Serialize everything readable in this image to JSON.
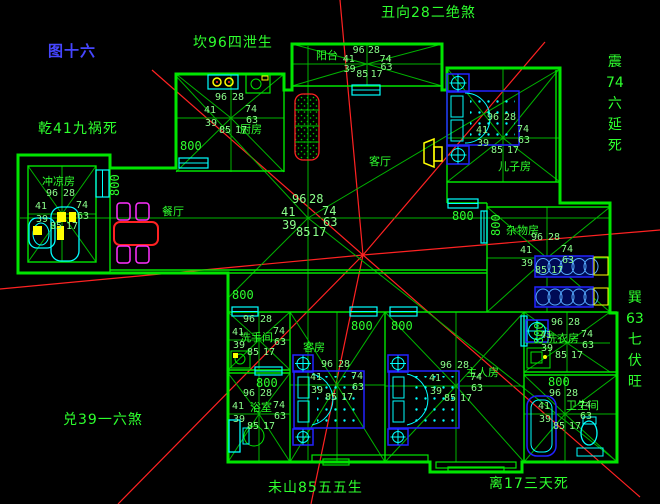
{
  "figure": {
    "label": "图十六",
    "color": "#4646ff"
  },
  "compass": {
    "top_left": {
      "text": "坎96四泄生",
      "x": 193,
      "y": 36
    },
    "top": {
      "text": "丑向28二绝煞",
      "x": 381,
      "y": 6
    },
    "left": {
      "text": "乾41九祸死",
      "x": 38,
      "y": 122
    },
    "bottom_left": {
      "text": "兑39一六煞",
      "x": 63,
      "y": 413
    },
    "bottom": {
      "text": "未山85五五生",
      "x": 268,
      "y": 481
    },
    "bottom_right": {
      "text": "离17三天死",
      "x": 489,
      "y": 477
    },
    "right_top": {
      "stack": [
        "震",
        "74",
        "六",
        "延",
        "死"
      ],
      "x": 606,
      "y": 55
    },
    "right_bottom": {
      "stack": [
        "巽",
        "63",
        "七",
        "伏",
        "旺"
      ],
      "x": 626,
      "y": 291
    }
  },
  "star_values": {
    "top_left": "96",
    "top_right": "28",
    "left": "41",
    "right": "74",
    "lower_left": "39",
    "lower_right": "63",
    "bottom_left": "85",
    "bottom_right": "17"
  },
  "dim_text": "800",
  "dimensions": [
    {
      "x": 180,
      "y": 140,
      "v": false
    },
    {
      "x": 109,
      "y": 196,
      "v": true
    },
    {
      "x": 232,
      "y": 289,
      "v": false
    },
    {
      "x": 452,
      "y": 210,
      "v": false
    },
    {
      "x": 490,
      "y": 236,
      "v": true
    },
    {
      "x": 351,
      "y": 320,
      "v": false
    },
    {
      "x": 391,
      "y": 320,
      "v": false
    },
    {
      "x": 533,
      "y": 344,
      "v": true
    },
    {
      "x": 548,
      "y": 376,
      "v": false
    },
    {
      "x": 256,
      "y": 377,
      "v": false
    }
  ],
  "rooms": [
    {
      "id": "kitchen",
      "label": "厨房",
      "rect": [
        176,
        74,
        108,
        98
      ],
      "center": [
        231,
        118
      ],
      "label_pos": [
        240,
        124
      ],
      "star": true,
      "numbers": true
    },
    {
      "id": "balcony",
      "label": "阳台",
      "rect": [
        292,
        44,
        150,
        42
      ],
      "center": [
        367,
        64
      ],
      "label_pos": [
        316,
        50
      ],
      "star": true,
      "numbers": true,
      "squeeze": [
        0.9,
        0.72
      ]
    },
    {
      "id": "son-room",
      "label": "儿子房",
      "rect": [
        447,
        68,
        113,
        114
      ],
      "center": [
        503,
        138
      ],
      "label_pos": [
        498,
        161
      ],
      "star": true,
      "numbers": true
    },
    {
      "id": "living",
      "label": "客厅",
      "rect": [
        110,
        90,
        450,
        183
      ],
      "center": [
        308,
        218
      ],
      "label_pos": [
        369,
        156
      ],
      "star": false,
      "numbers": true,
      "big": true
    },
    {
      "id": "dining",
      "label": "餐厅",
      "rect": [
        110,
        168,
        118,
        105
      ],
      "center": [
        165,
        212
      ],
      "label_pos": [
        162,
        206
      ],
      "star": false,
      "numbers": false
    },
    {
      "id": "bath-left",
      "label": "冲凉房",
      "rect": [
        28,
        166,
        68,
        96
      ],
      "center": [
        62,
        214
      ],
      "label_pos": [
        42,
        176
      ],
      "star": true,
      "numbers": true
    },
    {
      "id": "store-room",
      "label": "杂物房",
      "rect": [
        487,
        207,
        123,
        105
      ],
      "center": [
        547,
        258
      ],
      "label_pos": [
        506,
        225
      ],
      "star": true,
      "numbers": true
    },
    {
      "id": "washroom",
      "label": "洗手间",
      "rect": [
        228,
        312,
        62,
        58
      ],
      "center": [
        259,
        340
      ],
      "label_pos": [
        240,
        332
      ],
      "star": true,
      "numbers": true
    },
    {
      "id": "bathroom-2",
      "label": "浴室",
      "rect": [
        228,
        373,
        62,
        89
      ],
      "center": [
        259,
        414
      ],
      "label_pos": [
        250,
        402
      ],
      "star": true,
      "numbers": true
    },
    {
      "id": "guest-room",
      "label": "客房",
      "rect": [
        290,
        312,
        95,
        150
      ],
      "center": [
        337,
        385
      ],
      "label_pos": [
        303,
        342
      ],
      "star": true,
      "numbers": true
    },
    {
      "id": "master-room",
      "label": "主人房",
      "rect": [
        385,
        312,
        139,
        150
      ],
      "center": [
        456,
        386
      ],
      "label_pos": [
        466,
        367
      ],
      "star": true,
      "numbers": true
    },
    {
      "id": "laundry",
      "label": "洗衣房",
      "rect": [
        524,
        312,
        86,
        60
      ],
      "center": [
        567,
        343
      ],
      "label_pos": [
        546,
        333
      ],
      "star": true,
      "numbers": true
    },
    {
      "id": "bathroom-3",
      "label": "卫生间",
      "rect": [
        524,
        375,
        93,
        87
      ],
      "center": [
        565,
        414
      ],
      "label_pos": [
        566,
        400
      ],
      "star": true,
      "numbers": true
    }
  ],
  "colors": {
    "wall": "#00e600",
    "ray": "#00b400",
    "number": "#8cff8c",
    "text": "#2eff2e",
    "red": "#ff2222",
    "cyan": "#00ffff",
    "blue": "#2222ff",
    "yellow": "#ffff00",
    "magenta": "#ff30ff",
    "background": "#000000"
  }
}
